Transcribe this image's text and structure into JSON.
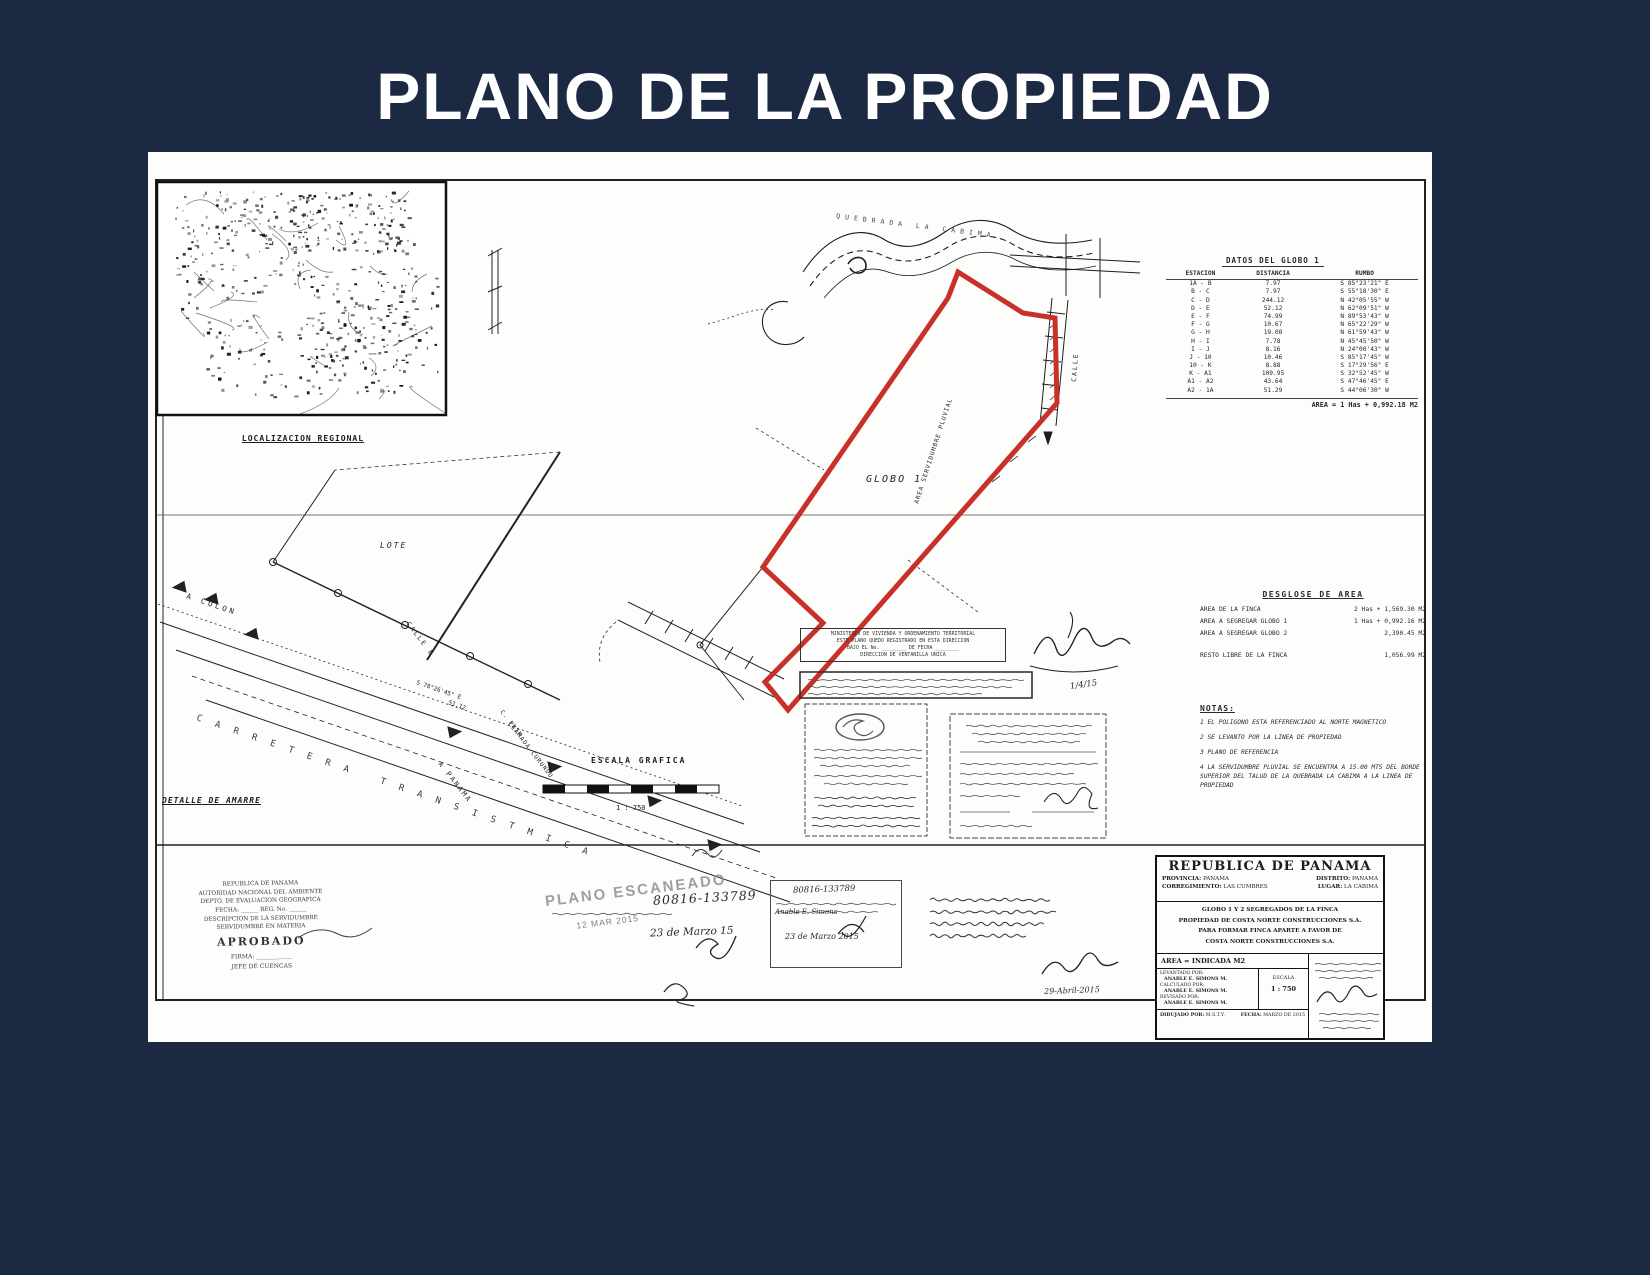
{
  "page": {
    "title": "PLANO DE LA PROPIEDAD",
    "background_color": "#1b2942",
    "paper_color": "#fdfdfc",
    "boundary_red": "#c8302a",
    "ink_color": "#1d1d1d"
  },
  "map_inset": {
    "caption": "LOCALIZACION REGIONAL"
  },
  "drawing": {
    "globo_label": "GLOBO 1",
    "lote_label": "LOTE",
    "a_colon_label": "A COLON",
    "a_panama_label": "A PANAMA",
    "carretera_label": "CARRETERA TRANSISTMICA",
    "calle_e_label": "CALLE E",
    "c_prim_line1": "C. PRIM.",
    "c_prim_line2": "LLAMADA CURUNDU",
    "quebrada_label": "QUEBRADA LA CABIMA",
    "servidumbre_label": "AREA SERVIDUMBRE PLUVIAL",
    "calle_label": "CALLE",
    "bearing_note": "S 78°26'45\" E",
    "bearing_dist": "51.12",
    "detalle_label": "DETALLE DE AMARRE",
    "escala_grafica_label": "ESCALA GRAFICA",
    "escala_ratio": "1 : 750"
  },
  "datos_table": {
    "title": "DATOS DEL GLOBO 1",
    "headers": [
      "ESTACION",
      "DISTANCIA",
      "RUMBO"
    ],
    "rows": [
      [
        "1A - B",
        "7.97",
        "S 85°23'21\" E"
      ],
      [
        "B - C",
        "7.97",
        "S 55°18'30\" E"
      ],
      [
        "C - D",
        "244.12",
        "N 42°05'55\" W"
      ],
      [
        "D - E",
        "52.12",
        "N 62°09'51\" W"
      ],
      [
        "E - F",
        "74.99",
        "N 89°53'43\" W"
      ],
      [
        "F - G",
        "10.67",
        "N 65°22'29\" W"
      ],
      [
        "G - H",
        "19.08",
        "N 61°59'43\" W"
      ],
      [
        "H - I",
        "7.78",
        "N 45°45'50\" W"
      ],
      [
        "I - J",
        "8.16",
        "N 24°00'43\" W"
      ],
      [
        "J - 10",
        "10.46",
        "S 85°17'45\" W"
      ],
      [
        "10 - K",
        "8.88",
        "S 17°29'56\" E"
      ],
      [
        "K - A1",
        "109.95",
        "S 32°52'45\" W"
      ],
      [
        "A1 - A2",
        "43.64",
        "S 47°46'45\" E"
      ],
      [
        "A2 - 1A",
        "51.29",
        "S 44°06'30\" W"
      ]
    ],
    "area_line": "AREA = 1 Has + 0,992.18 M2"
  },
  "desglose": {
    "title": "DESGLOSE DE AREA",
    "rows": [
      {
        "label": "AREA DE LA FINCA",
        "value": "2 Has + 1,569.30 M2"
      },
      {
        "label": "AREA A SEGREGAR GLOBO 1",
        "value": "1 Has + 0,992.16 M2"
      },
      {
        "label": "AREA A SEGREGAR GLOBO 2",
        "value": "2,390.45 M2"
      }
    ],
    "resto_label": "RESTO LIBRE DE LA FINCA",
    "resto_value": "1,056.99 M2"
  },
  "notas": {
    "title": "NOTAS:",
    "items": [
      "1  EL POLIGONO ESTA REFERENCIADO AL NORTE MAGNETICO",
      "2  SE LEVANTO POR LA LINEA DE PROPIEDAD",
      "3  PLANO DE REFERENCIA",
      "4  LA SERVIDUMBRE PLUVIAL SE ENCUENTRA A 15.00 MTS DEL BORDE SUPERIOR DEL TALUD DE LA QUEBRADA LA CABIMA A LA LINEA DE PROPIEDAD"
    ]
  },
  "title_block": {
    "country": "REPUBLICA DE PANAMA",
    "provincia_label": "PROVINCIA:",
    "provincia": "PANAMA",
    "distrito_label": "DISTRITO:",
    "distrito": "PANAMA",
    "corregimiento_label": "CORREGIMIENTO:",
    "corregimiento": "LAS CUMBRES",
    "lugar_label": "LUGAR:",
    "lugar": "LA CABIMA",
    "description_lines": [
      "GLOBO 1 Y 2 SEGREGADOS DE LA FINCA",
      "PROPIEDAD DE COSTA NORTE CONSTRUCCIONES S.A.",
      "PARA FORMAR FINCA APARTE A FAVOR DE",
      "COSTA NORTE CONSTRUCCIONES S.A."
    ],
    "area_line": "AREA = INDICADA M2",
    "credits": [
      {
        "label": "LEVANTADO POR:",
        "value": "ANABLE E. SIMONS M."
      },
      {
        "label": "CALCULADO POR:",
        "value": "ANABLE E. SIMONS M."
      },
      {
        "label": "REVISADO POR:",
        "value": "ANABLE E. SIMONS M."
      }
    ],
    "escala_label": "ESCALA",
    "escala": "1 : 750",
    "dibujado_label": "DIBUJADO POR:",
    "dibujado": "M.S.T.Y.",
    "fecha_label": "FECHA:",
    "fecha": "MARZO DE 2015"
  },
  "stamps": {
    "anam": {
      "lines": [
        "REPUBLICA DE PANAMA",
        "AUTORIDAD NACIONAL DEL AMBIENTE",
        "DEPTO. DE EVALUACION GEOGRAFICA",
        "FECHA: ______   REG. No. ______",
        "DESCRIPCION DE LA SERVIDUMBRE",
        "SERVIDUMBRE EN MATERIA"
      ],
      "approved": "APROBADO",
      "firma_line": "FIRMA: ____________",
      "jefe": "JEFE DE CUENCAS"
    },
    "miviot": {
      "lines": [
        "MINISTERIO DE VIVIENDA Y ORDENAMIENTO TERRITORIAL",
        "ESTE PLANO QUEDO REGISTRADO EN ESTA DIRECCION",
        "BAJO EL No. ________  DE FECHA ________",
        "DIRECCION DE VENTANILLA UNICA"
      ]
    },
    "escaneado": {
      "title": "PLANO ESCANEADO",
      "date": "12 MAR 2015"
    },
    "handwritten": {
      "plan_number": "80816-133789",
      "date_short": "23 de Marzo 15",
      "date_long": "23 de Marzo 2015",
      "surveyor": "Anable E. Simons",
      "approval_date": "29-Abril-2015",
      "flourish_date": "1/4/15"
    }
  }
}
